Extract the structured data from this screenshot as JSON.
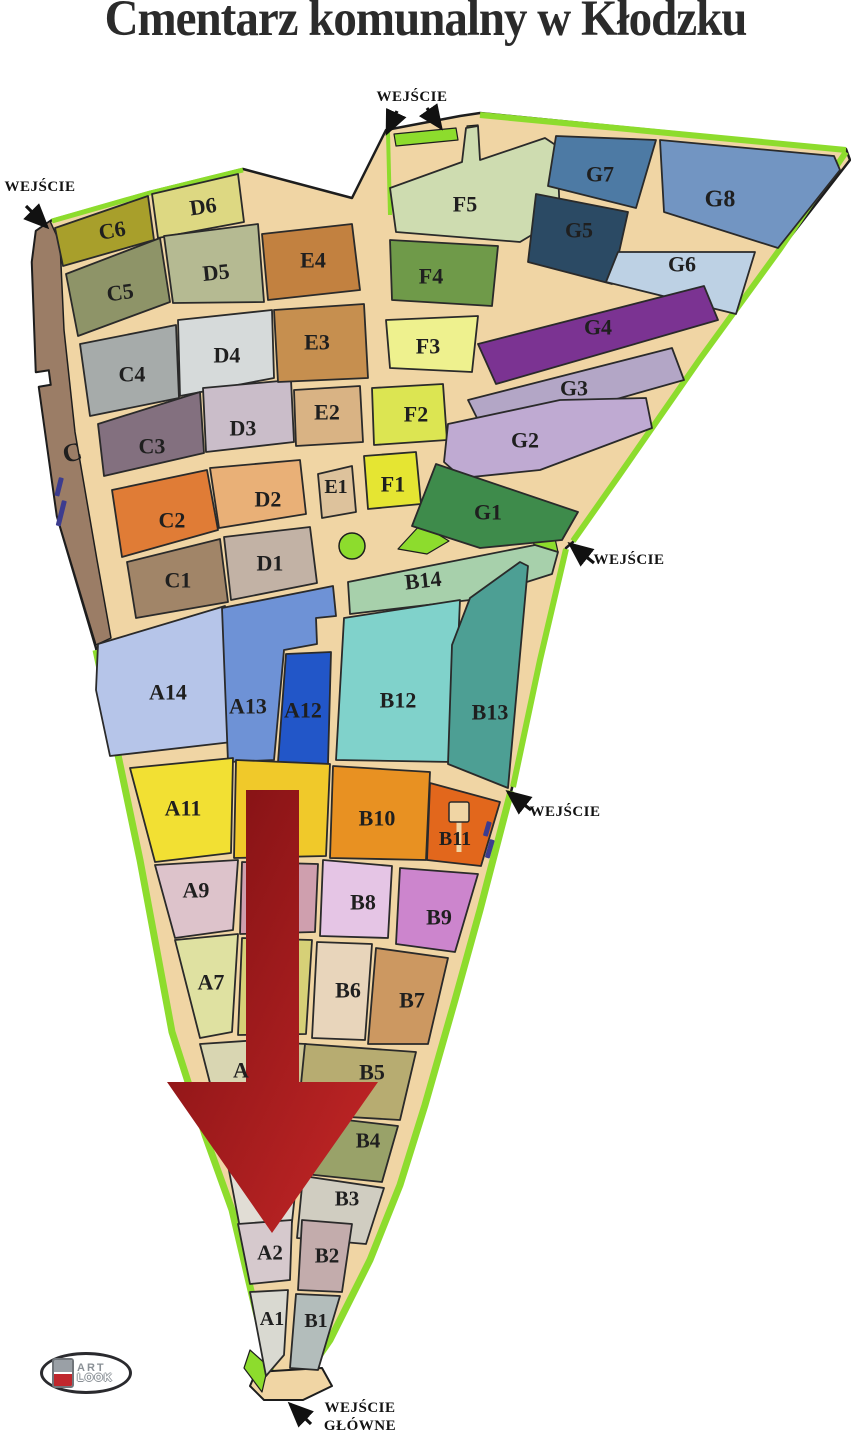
{
  "title": "Cmentarz komunalny w Kłodzku",
  "palette": {
    "background": "#ffffff",
    "path_tan": "#f0d5a4",
    "outline": "#1d1d1d",
    "section_stroke": "#2a2a2a",
    "edge_green": "#8ddc2d",
    "edge_brown": "#9b7d66",
    "label_color": "#1f1f1f",
    "entrance_text_color": "#121212",
    "arrow_red_dark": "#7a0f12",
    "arrow_red_light": "#c62727",
    "blue_marker": "#3c3c8f"
  },
  "map": {
    "silhouette": "52,220 150,192 243,169 352,198 386,130 460,116 480,113 846,149 850,160 780,250 700,360 618,478 573,542 566,548 540,660 512,788 480,910 455,1000 425,1105 400,1185 370,1260 330,1340 296,1390 282,1392 272,1377 252,1295 232,1210 205,1135 172,1032 140,860 96,648 57,516 39,387 51,385 49,370 36,372 32,262 36,231",
    "brown_strip": "50,221 36,231 32,262 36,372 49,370 51,385 39,387 57,516 96,645 111,638 97,560 75,432 64,330 60,243",
    "strip_label": "C",
    "strip_label_pos": [
      72,
      452
    ],
    "tip_courtyard": "256,1372 322,1368 332,1386 303,1400 264,1400 250,1386",
    "green_edges": [
      {
        "id": "edge-top-left",
        "points": "52,221 150,193 243,170",
        "width": 5
      },
      {
        "id": "edge-courtyard-left",
        "points": "388,132 390,215",
        "width": 4
      },
      {
        "id": "edge-top-right",
        "points": "480,115 846,150",
        "width": 6
      },
      {
        "id": "edge-right-upper",
        "points": "846,152 780,249 700,359 618,477 573,541",
        "width": 6
      },
      {
        "id": "edge-right-mid",
        "points": "566,549 540,660 513,787",
        "width": 6
      },
      {
        "id": "edge-right-lower",
        "points": "511,791 480,910 455,1000 425,1105 400,1185 370,1260 330,1340 297,1388",
        "width": 7
      },
      {
        "id": "edge-left",
        "points": "96,650 140,860 172,1032 205,1135 232,1210 252,1295 272,1377 281,1390",
        "width": 7
      }
    ],
    "green_shapes": [
      {
        "id": "green-circle",
        "type": "circle",
        "cx": 352,
        "cy": 546,
        "r": 13
      },
      {
        "id": "green-triangle",
        "type": "poly",
        "points": "398,549 421,524 449,541 427,554"
      },
      {
        "id": "green-tab-top",
        "type": "poly",
        "points": "394,134 456,128 458,140 396,146"
      },
      {
        "id": "green-notch",
        "type": "poly",
        "points": "467,126 478,125 479,156 468,157"
      },
      {
        "id": "green-entrance-square",
        "type": "poly",
        "points": "533,540 554,534 558,552 537,558"
      },
      {
        "id": "green-tip-blob",
        "type": "poly",
        "points": "250,1350 268,1366 262,1392 244,1368"
      }
    ],
    "sections": [
      {
        "id": "C6",
        "label": "C6",
        "color": "#a89f2b",
        "points": "55,228 148,196 154,240 63,266",
        "lx": 112,
        "ly": 230,
        "fs": 22,
        "rot": -10
      },
      {
        "id": "D6",
        "label": "D6",
        "color": "#ddd882",
        "points": "152,194 238,174 244,222 158,238",
        "lx": 203,
        "ly": 206,
        "fs": 22,
        "rot": -8
      },
      {
        "id": "C5",
        "label": "C5",
        "color": "#8e9468",
        "points": "66,274 160,238 170,302 78,336",
        "lx": 120,
        "ly": 292,
        "fs": 22,
        "rot": -8
      },
      {
        "id": "D5",
        "label": "D5",
        "color": "#b5ba92",
        "points": "164,236 258,224 264,302 173,303",
        "lx": 216,
        "ly": 272,
        "fs": 22,
        "rot": -6
      },
      {
        "id": "C4",
        "label": "C4",
        "color": "#a6abaa",
        "points": "80,344 176,325 179,398 90,416",
        "lx": 132,
        "ly": 374,
        "fs": 22
      },
      {
        "id": "D4",
        "label": "D4",
        "color": "#d6dada",
        "points": "178,320 272,310 274,378 180,396",
        "lx": 227,
        "ly": 355,
        "fs": 22
      },
      {
        "id": "C3",
        "label": "C3",
        "color": "#83707f",
        "points": "98,424 200,392 204,453 104,476",
        "lx": 152,
        "ly": 446,
        "fs": 22
      },
      {
        "id": "D3",
        "label": "D3",
        "color": "#cabdc9",
        "points": "203,388 291,380 294,442 206,452",
        "lx": 243,
        "ly": 428,
        "fs": 22
      },
      {
        "id": "C2",
        "label": "C2",
        "color": "#e07c36",
        "points": "112,490 207,470 218,530 122,557",
        "lx": 172,
        "ly": 520,
        "fs": 22
      },
      {
        "id": "D2",
        "label": "D2",
        "color": "#e9b077",
        "points": "210,468 300,460 306,514 219,528",
        "lx": 268,
        "ly": 499,
        "fs": 22
      },
      {
        "id": "C1",
        "label": "C1",
        "color": "#a18568",
        "points": "127,562 220,539 228,602 136,618",
        "lx": 178,
        "ly": 580,
        "fs": 22
      },
      {
        "id": "D1",
        "label": "D1",
        "color": "#c2b2a5",
        "points": "224,537 310,527 317,583 231,600",
        "lx": 270,
        "ly": 563,
        "fs": 22
      },
      {
        "id": "E4",
        "label": "E4",
        "color": "#c28140",
        "points": "262,234 352,224 360,290 268,300",
        "lx": 313,
        "ly": 260,
        "fs": 22
      },
      {
        "id": "E3",
        "label": "E3",
        "color": "#c68f4f",
        "points": "274,310 364,304 368,378 278,382",
        "lx": 317,
        "ly": 342,
        "fs": 22
      },
      {
        "id": "E2",
        "label": "E2",
        "color": "#d9b384",
        "points": "294,390 360,386 363,442 296,446",
        "lx": 327,
        "ly": 412,
        "fs": 22
      },
      {
        "id": "E1",
        "label": "E1",
        "color": "#ddc29c",
        "points": "318,474 352,466 356,512 322,518",
        "lx": 336,
        "ly": 486,
        "fs": 20
      },
      {
        "id": "F5",
        "label": "F5",
        "color": "#cedcb0",
        "points": "390,188 462,162 466,128 478,126 480,160 545,138 557,146 560,218 520,242 396,232",
        "lx": 465,
        "ly": 204,
        "fs": 22
      },
      {
        "id": "F4",
        "label": "F4",
        "color": "#6f9a49",
        "points": "390,240 498,246 492,306 392,300",
        "lx": 431,
        "ly": 276,
        "fs": 22
      },
      {
        "id": "F3",
        "label": "F3",
        "color": "#eef18e",
        "points": "386,320 478,316 472,372 390,368",
        "lx": 428,
        "ly": 346,
        "fs": 22
      },
      {
        "id": "F2",
        "label": "F2",
        "color": "#dce552",
        "points": "372,388 443,384 447,440 374,445",
        "lx": 416,
        "ly": 414,
        "fs": 22
      },
      {
        "id": "F1",
        "label": "F1",
        "color": "#e5e532",
        "points": "364,456 416,452 421,504 368,509",
        "lx": 393,
        "ly": 484,
        "fs": 22
      },
      {
        "id": "G7",
        "label": "G7",
        "color": "#4d7aa4",
        "points": "556,136 656,140 636,208 548,186",
        "lx": 600,
        "ly": 174,
        "fs": 22
      },
      {
        "id": "G8",
        "label": "G8",
        "color": "#7295c2",
        "points": "660,140 834,156 840,170 778,248 664,212",
        "lx": 720,
        "ly": 198,
        "fs": 24
      },
      {
        "id": "G5",
        "label": "G5",
        "color": "#2b4a64",
        "points": "536,194 628,212 612,284 528,262",
        "lx": 579,
        "ly": 230,
        "fs": 22
      },
      {
        "id": "G6",
        "label": "G6",
        "color": "#bdd1e4",
        "points": "618,252 755,252 736,314 606,282",
        "lx": 682,
        "ly": 264,
        "fs": 22
      },
      {
        "id": "G4",
        "label": "G4",
        "color": "#7b3392",
        "points": "478,344 704,286 718,320 496,384",
        "lx": 598,
        "ly": 327,
        "fs": 22
      },
      {
        "id": "G3",
        "label": "G3",
        "color": "#b3a6c6",
        "points": "468,400 672,348 684,380 486,436",
        "lx": 574,
        "ly": 388,
        "fs": 22
      },
      {
        "id": "G2",
        "label": "G2",
        "color": "#bfaad2",
        "points": "444,462 448,424 560,400 646,398 652,428 540,470 462,478",
        "lx": 525,
        "ly": 440,
        "fs": 22
      },
      {
        "id": "G1",
        "label": "G1",
        "color": "#3e8b4b",
        "points": "436,464 578,512 562,540 480,548 412,526",
        "lx": 488,
        "ly": 512,
        "fs": 22
      },
      {
        "id": "B14",
        "label": "B14",
        "color": "#a7d0ab",
        "points": "348,582 535,545 558,552 552,574 470,600 350,614",
        "lx": 423,
        "ly": 580,
        "fs": 22,
        "rot": -6
      },
      {
        "id": "A14",
        "label": "A14",
        "color": "#b6c5e9",
        "points": "98,644 225,606 232,742 110,756 96,690",
        "lx": 168,
        "ly": 692,
        "fs": 22
      },
      {
        "id": "A13",
        "label": "A13",
        "color": "#6e92d6",
        "points": "222,608 333,586 336,616 316,618 317,644 284,650 274,760 228,762",
        "lx": 248,
        "ly": 706,
        "fs": 22
      },
      {
        "id": "A12",
        "label": "A12",
        "color": "#2256c8",
        "points": "286,654 331,652 328,764 278,762",
        "lx": 303,
        "ly": 710,
        "fs": 22
      },
      {
        "id": "B12",
        "label": "B12",
        "color": "#80d2cb",
        "points": "344,618 460,600 453,762 336,760",
        "lx": 398,
        "ly": 700,
        "fs": 22
      },
      {
        "id": "B13",
        "label": "B13",
        "color": "#4d9f94",
        "points": "470,598 520,562 528,566 508,788 448,764 452,645",
        "lx": 490,
        "ly": 712,
        "fs": 22
      },
      {
        "id": "A11",
        "label": "A11",
        "color": "#f2e033",
        "points": "130,768 233,758 231,853 155,862",
        "lx": 183,
        "ly": 808,
        "fs": 22
      },
      {
        "id": "A10",
        "label": "",
        "color": "#f0c92a",
        "points": "236,760 330,764 326,856 234,858",
        "lx": 280,
        "ly": 812,
        "fs": 22
      },
      {
        "id": "B10",
        "label": "B10",
        "color": "#e89122",
        "points": "333,766 430,772 426,860 330,858",
        "lx": 377,
        "ly": 818,
        "fs": 22
      },
      {
        "id": "B11",
        "label": "B11",
        "color": "#e2671c",
        "points": "430,783 500,802 481,866 427,860",
        "lx": 455,
        "ly": 838,
        "fs": 20
      },
      {
        "id": "A9",
        "label": "A9",
        "color": "#ddc3cb",
        "points": "155,865 238,860 233,930 175,938",
        "lx": 196,
        "ly": 890,
        "fs": 22
      },
      {
        "id": "A8",
        "label": "",
        "color": "#cf9fae",
        "points": "242,862 318,864 315,932 240,934",
        "lx": 278,
        "ly": 898,
        "fs": 22
      },
      {
        "id": "B8",
        "label": "B8",
        "color": "#e5c5e5",
        "points": "323,860 392,866 388,938 320,936",
        "lx": 363,
        "ly": 902,
        "fs": 22
      },
      {
        "id": "B9",
        "label": "B9",
        "color": "#cc85cd",
        "points": "400,868 478,874 455,952 396,944",
        "lx": 439,
        "ly": 917,
        "fs": 22
      },
      {
        "id": "A7",
        "label": "A7",
        "color": "#dfe1a1",
        "points": "175,940 238,934 232,1032 200,1038",
        "lx": 211,
        "ly": 982,
        "fs": 22
      },
      {
        "id": "A6",
        "label": "",
        "color": "#d6d077",
        "points": "242,938 312,940 306,1034 238,1035",
        "lx": 275,
        "ly": 985,
        "fs": 22
      },
      {
        "id": "B6",
        "label": "B6",
        "color": "#e8d5bb",
        "points": "317,942 372,944 365,1040 312,1038",
        "lx": 348,
        "ly": 990,
        "fs": 22
      },
      {
        "id": "B7",
        "label": "B7",
        "color": "#cc9861",
        "points": "376,948 448,958 428,1044 368,1044",
        "lx": 412,
        "ly": 1000,
        "fs": 22
      },
      {
        "id": "A5",
        "label": "A",
        "color": "#d9d6b2",
        "points": "200,1044 260,1040 254,1126 222,1130",
        "lx": 241,
        "ly": 1070,
        "fs": 22
      },
      {
        "id": "A4",
        "label": "",
        "color": "#cfc795",
        "points": "264,1042 306,1044 298,1132 256,1130",
        "lx": 280,
        "ly": 1085,
        "fs": 22
      },
      {
        "id": "B5",
        "label": "B5",
        "color": "#b7ac71",
        "points": "305,1044 416,1052 400,1120 298,1114",
        "lx": 372,
        "ly": 1072,
        "fs": 22
      },
      {
        "id": "B4",
        "label": "B4",
        "color": "#99a269",
        "points": "312,1116 398,1126 382,1182 305,1174",
        "lx": 368,
        "ly": 1140,
        "fs": 21
      },
      {
        "id": "B3",
        "label": "B3",
        "color": "#d0cdc1",
        "points": "303,1176 384,1188 366,1244 297,1238",
        "lx": 347,
        "ly": 1198,
        "fs": 21
      },
      {
        "id": "A3",
        "label": "",
        "color": "#e1ddd5",
        "points": "222,1134 258,1132 295,1194 292,1222 240,1228",
        "lx": 258,
        "ly": 1180,
        "fs": 21
      },
      {
        "id": "A2",
        "label": "A2",
        "color": "#d6c9cd",
        "points": "238,1224 292,1220 290,1280 250,1284",
        "lx": 270,
        "ly": 1252,
        "fs": 21
      },
      {
        "id": "B2",
        "label": "B2",
        "color": "#c3acac",
        "points": "302,1220 352,1224 342,1292 298,1290",
        "lx": 327,
        "ly": 1255,
        "fs": 21
      },
      {
        "id": "A1",
        "label": "A1",
        "color": "#d9d9d1",
        "points": "250,1292 288,1290 284,1355 266,1376",
        "lx": 272,
        "ly": 1318,
        "fs": 20
      },
      {
        "id": "B1",
        "label": "B1",
        "color": "#b3bdbb",
        "points": "296,1294 340,1296 318,1370 290,1368",
        "lx": 316,
        "ly": 1320,
        "fs": 20
      }
    ],
    "building": {
      "rect": [
        449,
        802,
        20,
        20
      ],
      "stem": [
        459,
        822,
        459,
        852
      ]
    },
    "blue_markers": [
      {
        "x": 59,
        "y": 477,
        "w": 5,
        "h": 19,
        "rot": 14
      },
      {
        "x": 62,
        "y": 500,
        "w": 5,
        "h": 26,
        "rot": 14
      },
      {
        "x": 487,
        "y": 821,
        "w": 5,
        "h": 15,
        "rot": 16
      },
      {
        "x": 490,
        "y": 839,
        "w": 5,
        "h": 19,
        "rot": 16
      }
    ],
    "red_arrow": "246,790 299,790 299,1082 378,1082 272,1233 167,1082 246,1082",
    "entrances": [
      {
        "id": "top-left",
        "lines": [
          "WEJŚCIE"
        ],
        "tx": 40,
        "ty": 191,
        "arrows": [
          [
            26,
            206,
            47,
            227
          ]
        ]
      },
      {
        "id": "top-middle",
        "lines": [
          "WEJŚCIE"
        ],
        "tx": 412,
        "ty": 101,
        "arrows": [
          [
            397,
            111,
            387,
            133
          ],
          [
            427,
            108,
            441,
            128
          ]
        ]
      },
      {
        "id": "right-middle",
        "lines": [
          "WEJŚCIE"
        ],
        "tx": 629,
        "ty": 564,
        "arrows": [
          [
            594,
            563,
            570,
            544
          ]
        ]
      },
      {
        "id": "right-lower",
        "lines": [
          "WEJŚCIE"
        ],
        "tx": 565,
        "ty": 816,
        "arrows": [
          [
            531,
            810,
            508,
            792
          ]
        ]
      },
      {
        "id": "main-bottom",
        "lines": [
          "WEJŚCIE",
          "GŁÓWNE"
        ],
        "tx": 360,
        "ty": 1412,
        "arrows": [
          [
            311,
            1424,
            290,
            1404
          ]
        ]
      }
    ]
  },
  "logo": {
    "line1": "ART",
    "line2": "LOOK"
  }
}
